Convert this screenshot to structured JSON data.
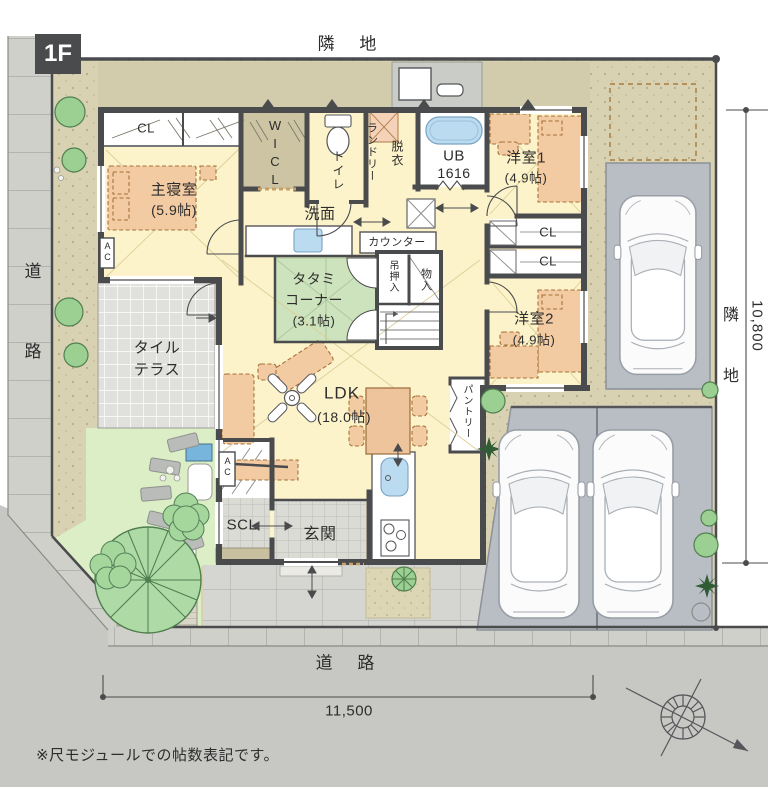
{
  "floor_badge": "1F",
  "boundaries": {
    "top": "隣 地",
    "left": "道 路",
    "right": "隣 地",
    "bottom": "道 路"
  },
  "dimensions": {
    "site_width": "11,500",
    "site_depth": "10,800"
  },
  "note": "※尺モジュールでの帖数表記です。",
  "rooms": {
    "master_name": "主寝室",
    "master_size": "(5.9帖)",
    "closet_master": "CL",
    "wicl": "WICL",
    "toilet": "トイレ",
    "laundry": "ランドリー",
    "datsui": "脱衣",
    "ub_name": "UB",
    "ub_size": "1616",
    "west1_name": "洋室1",
    "west1_size": "(4.9帖)",
    "closet1": "CL",
    "closet2": "CL",
    "west2_name": "洋室2",
    "west2_size": "(4.9帖)",
    "senmen": "洗面",
    "counter": "カウンター",
    "tatami_l1": "タタミ",
    "tatami_l2": "コーナー",
    "tatami_size": "(3.1帖)",
    "tsuri_oshiire": "吊押入",
    "mono_ire": "物入",
    "ldk_name": "LDK",
    "ldk_size": "(18.0帖)",
    "pantry": "パントリー",
    "scl": "SCL",
    "genkan": "玄関",
    "terrace_l1": "タイル",
    "terrace_l2": "テラス",
    "ac1": "AC",
    "ac2": "AC"
  },
  "colors": {
    "wall": "#4a4b4d",
    "floor": "#fcf3cb",
    "tatami_green": "#cde3bd",
    "site_beige": "#d9d2b2",
    "furniture": "#f3cba3",
    "water_blue": "#badbf0",
    "road_gray": "#c7c8c4"
  }
}
